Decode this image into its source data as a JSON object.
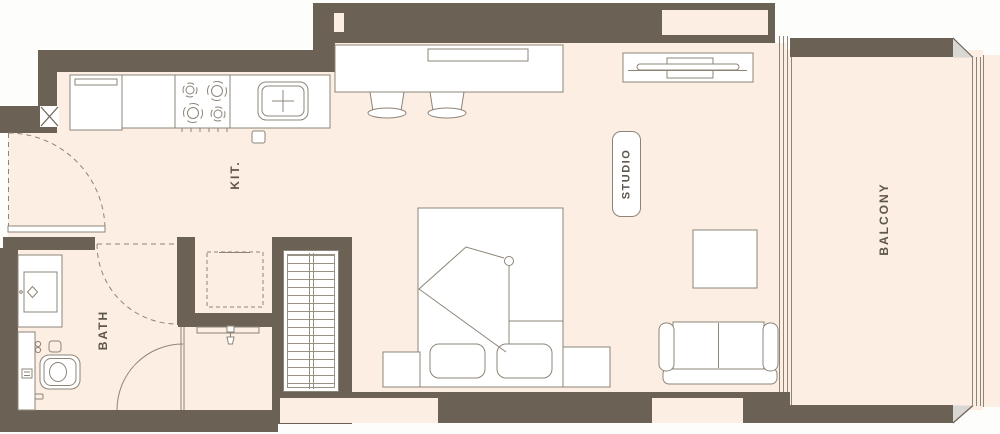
{
  "labels": {
    "kitchen": "KIT.",
    "studio": "STUDIO",
    "bath": "BATH",
    "balcony": "BALCONY"
  },
  "colors": {
    "wall": "#6b6155",
    "floor": "#fceee2",
    "line": "#8d8478",
    "line_light": "#9a9185",
    "text": "#5d564c",
    "chamfer": "#d8d7d4"
  },
  "fixtures": [
    "fridge-icon",
    "stove-burners-icon",
    "kitchen-sink-icon",
    "bar-counter",
    "bar-stool-icon",
    "tv-unit-icon",
    "bed-icon",
    "pillow-icon",
    "nightstand",
    "wardrobe-hangers-icon",
    "sofa-icon",
    "coffee-table",
    "vanity-sink-icon",
    "toilet-icon",
    "shower-head-icon",
    "washer-space-dashed",
    "door-swing-arc",
    "balcony-railing",
    "shaft-column-x-icon",
    "window-opening"
  ]
}
